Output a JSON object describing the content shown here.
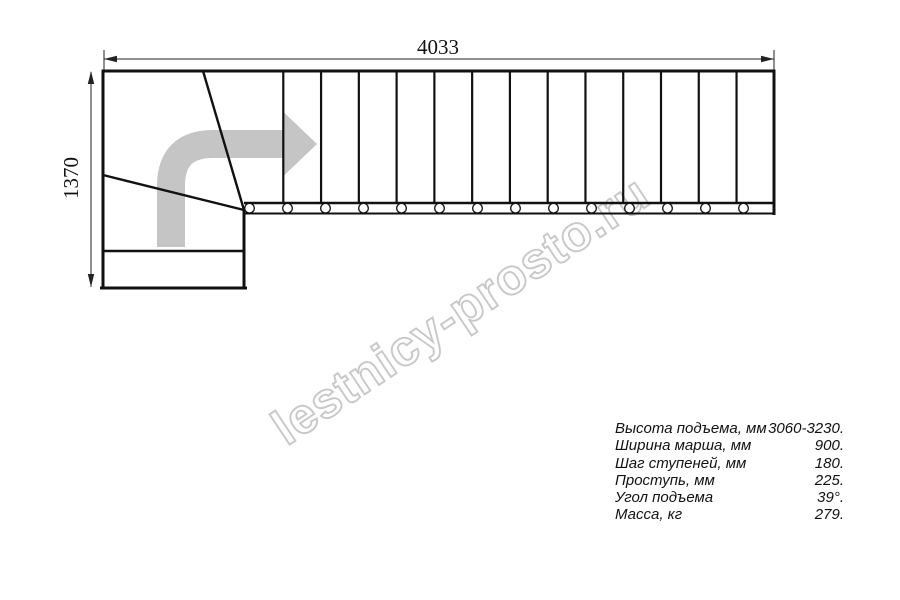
{
  "diagram": {
    "kind": "L-shaped staircase plan, top view",
    "dimensions": {
      "width": "4033",
      "height": "1370"
    },
    "straight_flight": {
      "tread_lines": 13,
      "treads": 14,
      "balusters": 14
    },
    "direction_arrow": "turn-right-then-straight",
    "colors": {
      "line": "#111111",
      "arrow": "#c5c5c5",
      "watermark": "#c3c3c3",
      "background": "#ffffff"
    }
  },
  "specs": {
    "rows": [
      {
        "label": "Высота подъема, мм",
        "value": "3060-3230."
      },
      {
        "label": "Ширина марша, мм",
        "value": "900."
      },
      {
        "label": "Шаг ступеней, мм",
        "value": "180."
      },
      {
        "label": "Проступь, мм",
        "value": "225."
      },
      {
        "label": "Угол подъема",
        "value": "39°."
      },
      {
        "label": "Масса, кг",
        "value": "279."
      }
    ]
  },
  "watermark": {
    "text": "lestnicy-prosto.ru"
  }
}
